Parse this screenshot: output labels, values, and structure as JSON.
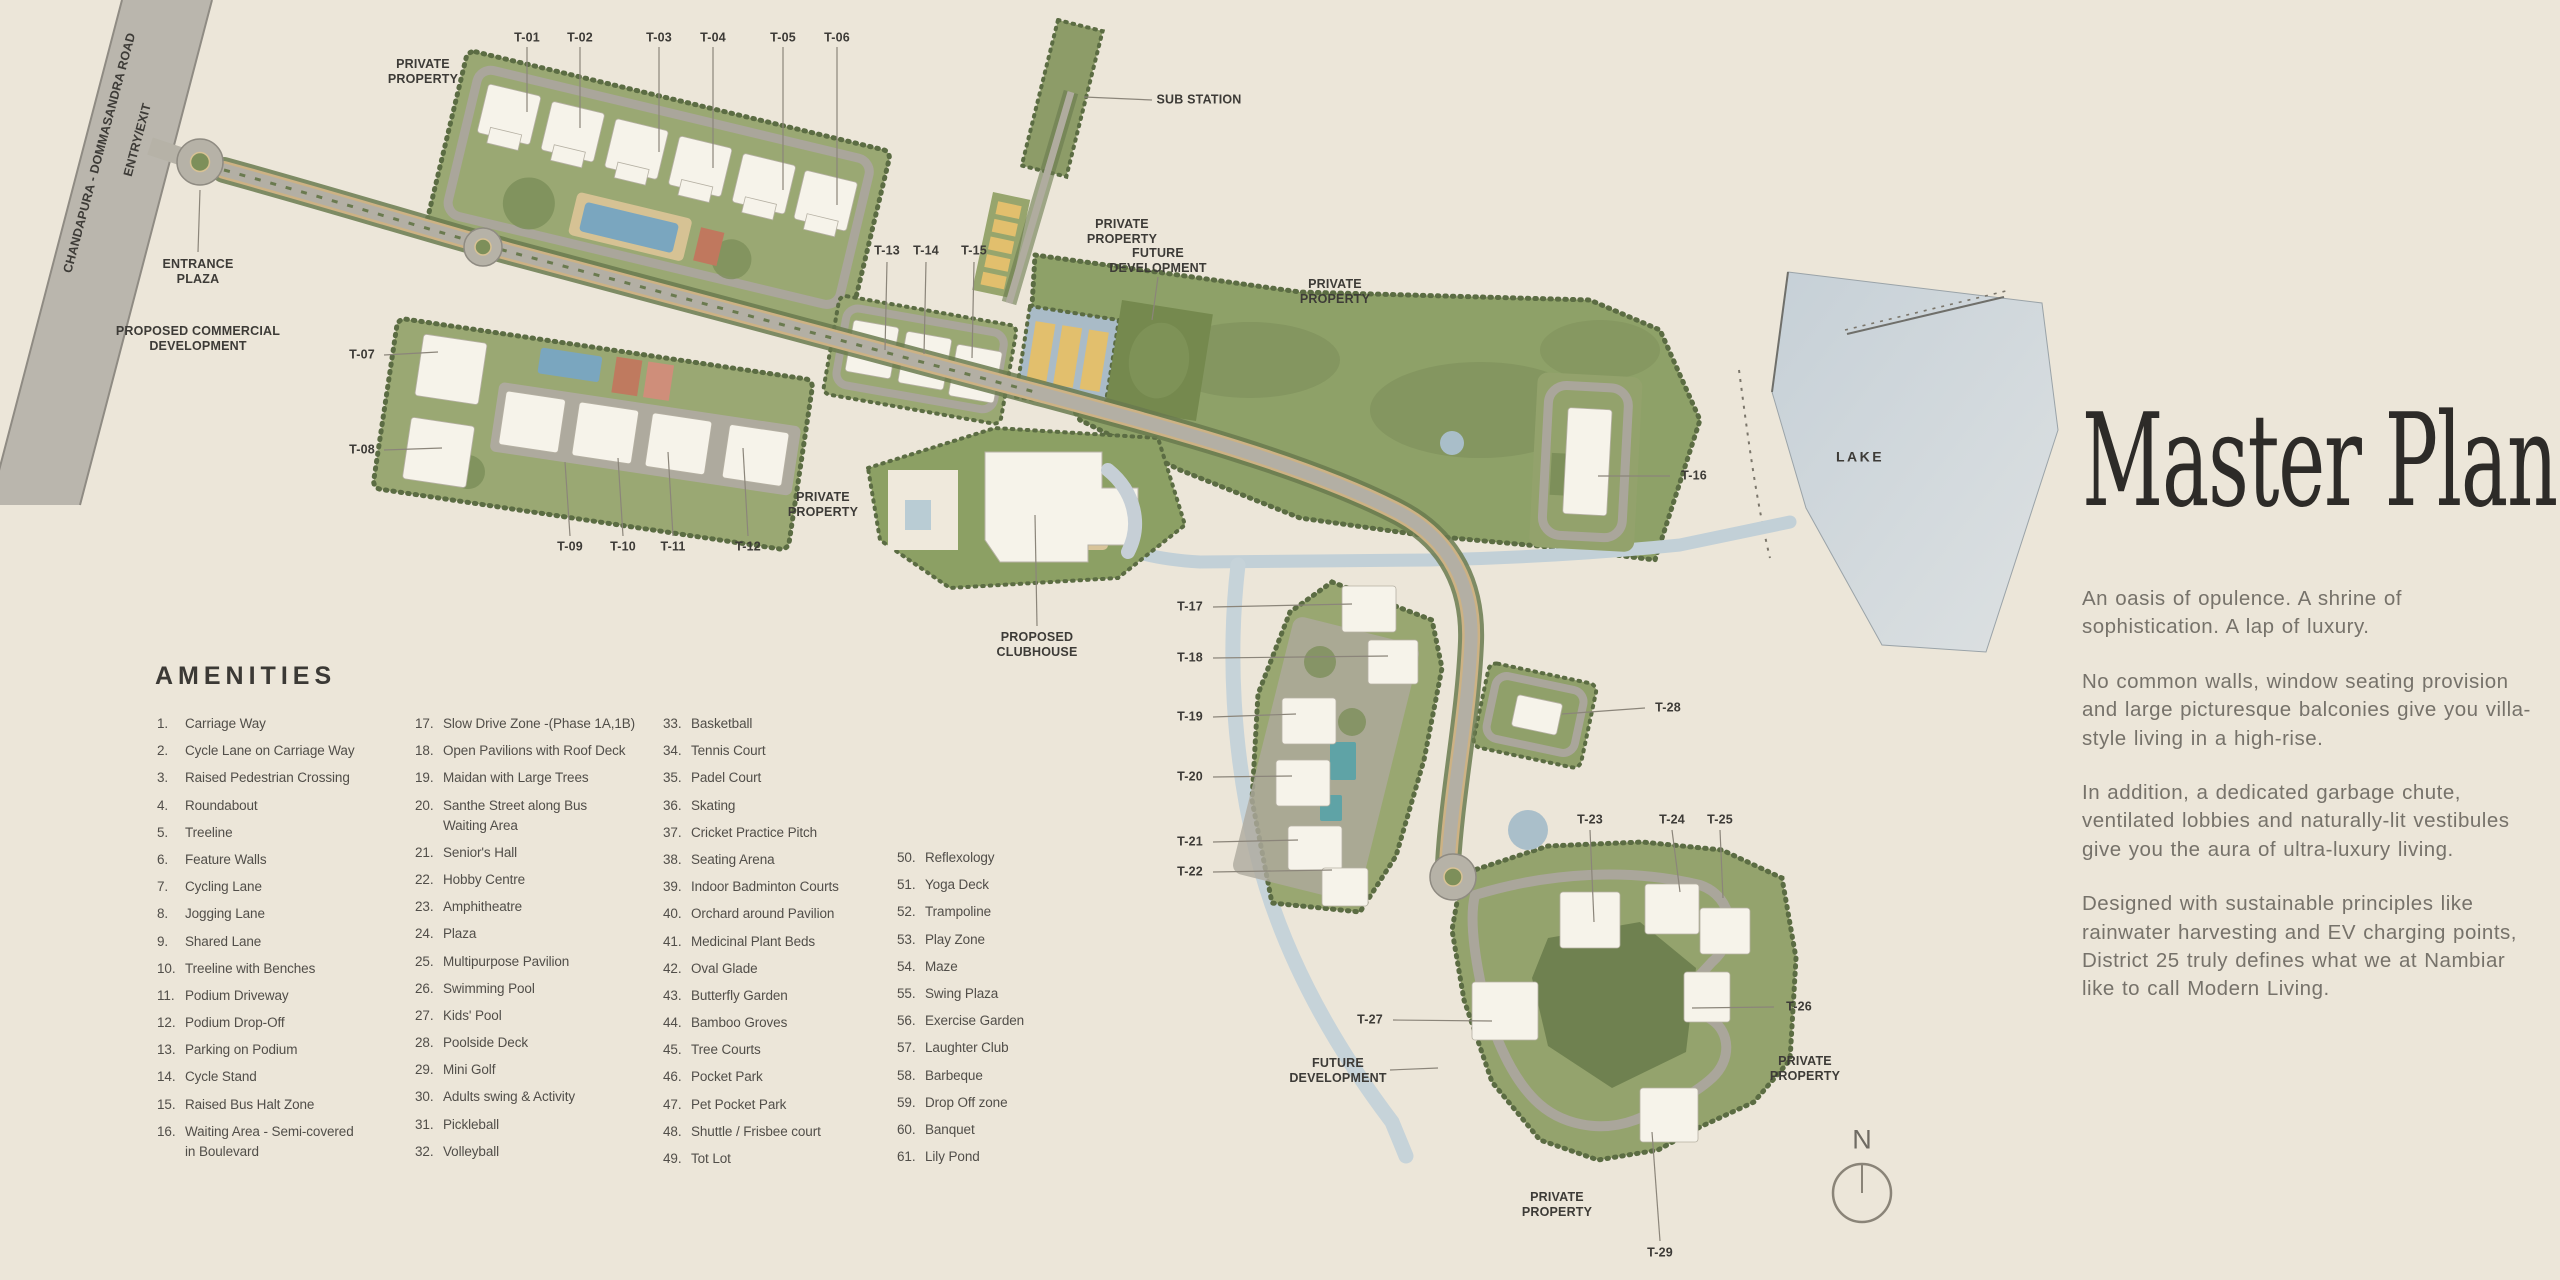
{
  "map": {
    "compass_n": "N",
    "towers": [
      {
        "id": "T-01",
        "x": 527,
        "y": 38,
        "leader": [
          527,
          47,
          527,
          112
        ]
      },
      {
        "id": "T-02",
        "x": 580,
        "y": 38,
        "leader": [
          580,
          47,
          580,
          128
        ]
      },
      {
        "id": "T-03",
        "x": 659,
        "y": 38,
        "leader": [
          659,
          47,
          659,
          152
        ]
      },
      {
        "id": "T-04",
        "x": 713,
        "y": 38,
        "leader": [
          713,
          47,
          713,
          168
        ]
      },
      {
        "id": "T-05",
        "x": 783,
        "y": 38,
        "leader": [
          783,
          47,
          783,
          190
        ]
      },
      {
        "id": "T-06",
        "x": 837,
        "y": 38,
        "leader": [
          837,
          47,
          837,
          205
        ]
      },
      {
        "id": "T-07",
        "x": 362,
        "y": 355,
        "leader": [
          384,
          355,
          438,
          352
        ]
      },
      {
        "id": "T-08",
        "x": 362,
        "y": 450,
        "leader": [
          384,
          450,
          442,
          448
        ]
      },
      {
        "id": "T-09",
        "x": 570,
        "y": 547,
        "leader": [
          570,
          536,
          565,
          462
        ]
      },
      {
        "id": "T-10",
        "x": 623,
        "y": 547,
        "leader": [
          623,
          536,
          618,
          458
        ]
      },
      {
        "id": "T-11",
        "x": 673,
        "y": 547,
        "leader": [
          673,
          536,
          668,
          452
        ]
      },
      {
        "id": "T-12",
        "x": 748,
        "y": 547,
        "leader": [
          748,
          536,
          743,
          448
        ]
      },
      {
        "id": "T-13",
        "x": 887,
        "y": 251,
        "leader": [
          887,
          262,
          885,
          350
        ]
      },
      {
        "id": "T-14",
        "x": 926,
        "y": 251,
        "leader": [
          926,
          262,
          924,
          354
        ]
      },
      {
        "id": "T-15",
        "x": 974,
        "y": 251,
        "leader": [
          974,
          262,
          972,
          358
        ]
      },
      {
        "id": "T-16",
        "x": 1694,
        "y": 476,
        "leader": [
          1670,
          476,
          1598,
          476
        ]
      },
      {
        "id": "T-17",
        "x": 1190,
        "y": 607,
        "leader": [
          1213,
          607,
          1352,
          604
        ]
      },
      {
        "id": "T-18",
        "x": 1190,
        "y": 658,
        "leader": [
          1213,
          658,
          1388,
          656
        ]
      },
      {
        "id": "T-19",
        "x": 1190,
        "y": 717,
        "leader": [
          1213,
          717,
          1296,
          714
        ]
      },
      {
        "id": "T-20",
        "x": 1190,
        "y": 777,
        "leader": [
          1213,
          777,
          1292,
          776
        ]
      },
      {
        "id": "T-21",
        "x": 1190,
        "y": 842,
        "leader": [
          1213,
          842,
          1298,
          840
        ]
      },
      {
        "id": "T-22",
        "x": 1190,
        "y": 872,
        "leader": [
          1213,
          872,
          1332,
          870
        ]
      },
      {
        "id": "T-23",
        "x": 1590,
        "y": 820,
        "leader": [
          1590,
          830,
          1594,
          922
        ]
      },
      {
        "id": "T-24",
        "x": 1672,
        "y": 820,
        "leader": [
          1672,
          830,
          1680,
          892
        ]
      },
      {
        "id": "T-25",
        "x": 1720,
        "y": 820,
        "leader": [
          1720,
          830,
          1723,
          898
        ]
      },
      {
        "id": "T-26",
        "x": 1799,
        "y": 1007,
        "leader": [
          1774,
          1007,
          1692,
          1008
        ]
      },
      {
        "id": "T-27",
        "x": 1370,
        "y": 1020,
        "leader": [
          1393,
          1020,
          1492,
          1021
        ]
      },
      {
        "id": "T-28",
        "x": 1668,
        "y": 708,
        "leader": [
          1645,
          708,
          1562,
          714
        ]
      },
      {
        "id": "T-29",
        "x": 1660,
        "y": 1253,
        "leader": [
          1660,
          1241,
          1652,
          1132
        ]
      }
    ],
    "area_labels": [
      {
        "name": "private-property-1",
        "text": "PRIVATE\nPROPERTY",
        "x": 423,
        "y": 72
      },
      {
        "name": "sub-station",
        "text": "SUB STATION",
        "x": 1199,
        "y": 100,
        "leader": [
          1152,
          100,
          1084,
          97
        ]
      },
      {
        "name": "private-property-2",
        "text": "PRIVATE\nPROPERTY",
        "x": 1122,
        "y": 232
      },
      {
        "name": "future-development-1",
        "text": "FUTURE\nDEVELOPMENT",
        "x": 1158,
        "y": 261,
        "leader": [
          1158,
          277,
          1152,
          320
        ]
      },
      {
        "name": "private-property-3",
        "text": "PRIVATE\nPROPERTY",
        "x": 1335,
        "y": 292
      },
      {
        "name": "entrance-plaza",
        "text": "ENTRANCE\nPLAZA",
        "x": 198,
        "y": 272,
        "leader": [
          198,
          252,
          200,
          190
        ]
      },
      {
        "name": "proposed-commercial-development",
        "text": "PROPOSED COMMERCIAL\nDEVELOPMENT",
        "x": 198,
        "y": 339
      },
      {
        "name": "private-property-4",
        "text": "PRIVATE\nPROPERTY",
        "x": 823,
        "y": 505
      },
      {
        "name": "proposed-clubhouse",
        "text": "PROPOSED\nCLUBHOUSE",
        "x": 1037,
        "y": 645,
        "leader": [
          1037,
          626,
          1035,
          515
        ]
      },
      {
        "name": "lake",
        "text": "LAKE",
        "x": 1860,
        "y": 457,
        "cls": "lake"
      },
      {
        "name": "private-property-5",
        "text": "PRIVATE\nPROPERTY",
        "x": 1805,
        "y": 1069
      },
      {
        "name": "future-development-2",
        "text": "FUTURE\nDEVELOPMENT",
        "x": 1338,
        "y": 1071,
        "leader": [
          1390,
          1070,
          1438,
          1068
        ]
      },
      {
        "name": "private-property-6",
        "text": "PRIVATE\nPROPERTY",
        "x": 1557,
        "y": 1205
      },
      {
        "name": "entry-exit",
        "text": "ENTRY/EXIT",
        "x": 138,
        "y": 140,
        "rotate": -75
      },
      {
        "name": "chandapura-dommasandra-road",
        "text": "CHANDAPURA - DOMMASANDRA ROAD",
        "x": 100,
        "y": 153,
        "rotate": -75
      }
    ]
  },
  "amenities": {
    "title": "AMENITIES",
    "columns": [
      {
        "x": 157,
        "top": 714,
        "items": [
          {
            "n": "1.",
            "label": "Carriage Way"
          },
          {
            "n": "2.",
            "label": "Cycle Lane on Carriage Way"
          },
          {
            "n": "3.",
            "label": "Raised Pedestrian Crossing"
          },
          {
            "n": "4.",
            "label": "Roundabout"
          },
          {
            "n": "5.",
            "label": "Treeline"
          },
          {
            "n": "6.",
            "label": "Feature Walls"
          },
          {
            "n": "7.",
            "label": "Cycling Lane"
          },
          {
            "n": "8.",
            "label": "Jogging Lane"
          },
          {
            "n": "9.",
            "label": "Shared Lane"
          },
          {
            "n": "10.",
            "label": "Treeline with Benches"
          },
          {
            "n": "11.",
            "label": "Podium Driveway"
          },
          {
            "n": "12.",
            "label": "Podium Drop-Off"
          },
          {
            "n": "13.",
            "label": "Parking on Podium"
          },
          {
            "n": "14.",
            "label": "Cycle Stand"
          },
          {
            "n": "15.",
            "label": "Raised Bus Halt Zone"
          },
          {
            "n": "16.",
            "label": "Waiting Area - Semi-covered\nin Boulevard"
          }
        ]
      },
      {
        "x": 415,
        "top": 714,
        "items": [
          {
            "n": "17.",
            "label": "Slow Drive Zone -(Phase 1A,1B)"
          },
          {
            "n": "18.",
            "label": "Open Pavilions with Roof Deck"
          },
          {
            "n": "19.",
            "label": "Maidan with Large Trees"
          },
          {
            "n": "20.",
            "label": "Santhe Street along Bus\nWaiting Area"
          },
          {
            "n": "21.",
            "label": "Senior's Hall"
          },
          {
            "n": "22.",
            "label": "Hobby Centre"
          },
          {
            "n": "23.",
            "label": "Amphitheatre"
          },
          {
            "n": "24.",
            "label": "Plaza"
          },
          {
            "n": "25.",
            "label": "Multipurpose Pavilion"
          },
          {
            "n": "26.",
            "label": "Swimming Pool"
          },
          {
            "n": "27.",
            "label": "Kids' Pool"
          },
          {
            "n": "28.",
            "label": "Poolside Deck"
          },
          {
            "n": "29.",
            "label": "Mini Golf"
          },
          {
            "n": "30.",
            "label": "Adults swing & Activity"
          },
          {
            "n": "31.",
            "label": "Pickleball"
          },
          {
            "n": "32.",
            "label": "Volleyball"
          }
        ]
      },
      {
        "x": 663,
        "top": 714,
        "items": [
          {
            "n": "33.",
            "label": "Basketball"
          },
          {
            "n": "34.",
            "label": "Tennis Court"
          },
          {
            "n": "35.",
            "label": "Padel Court"
          },
          {
            "n": "36.",
            "label": "Skating"
          },
          {
            "n": "37.",
            "label": "Cricket Practice Pitch"
          },
          {
            "n": "38.",
            "label": "Seating Arena"
          },
          {
            "n": "39.",
            "label": "Indoor Badminton Courts"
          },
          {
            "n": "40.",
            "label": "Orchard around Pavilion"
          },
          {
            "n": "41.",
            "label": "Medicinal Plant Beds"
          },
          {
            "n": "42.",
            "label": "Oval Glade"
          },
          {
            "n": "43.",
            "label": "Butterfly Garden"
          },
          {
            "n": "44.",
            "label": "Bamboo Groves"
          },
          {
            "n": "45.",
            "label": "Tree Courts"
          },
          {
            "n": "46.",
            "label": "Pocket Park"
          },
          {
            "n": "47.",
            "label": "Pet Pocket Park"
          },
          {
            "n": "48.",
            "label": "Shuttle / Frisbee court"
          },
          {
            "n": "49.",
            "label": "Tot Lot"
          }
        ]
      },
      {
        "x": 897,
        "top": 848,
        "items": [
          {
            "n": "50.",
            "label": "Reflexology"
          },
          {
            "n": "51.",
            "label": "Yoga Deck"
          },
          {
            "n": "52.",
            "label": "Trampoline"
          },
          {
            "n": "53.",
            "label": "Play Zone"
          },
          {
            "n": "54.",
            "label": "Maze"
          },
          {
            "n": "55.",
            "label": "Swing Plaza"
          },
          {
            "n": "56.",
            "label": "Exercise Garden"
          },
          {
            "n": "57.",
            "label": "Laughter Club"
          },
          {
            "n": "58.",
            "label": "Barbeque"
          },
          {
            "n": "59.",
            "label": "Drop Off zone"
          },
          {
            "n": "60.",
            "label": "Banquet"
          },
          {
            "n": "61.",
            "label": "Lily Pond"
          }
        ]
      }
    ]
  },
  "panel": {
    "title": "Master Plan",
    "paragraphs": [
      "An oasis of opulence. A shrine of sophistication. A lap of luxury.",
      "No common walls, window seating provision and large picturesque balconies give you villa-style living in a high-rise.",
      "In addition, a dedicated garbage chute, ventilated lobbies and naturally-lit vestibules give you the aura of ultra-luxury living.",
      "Designed with sustainable principles like rainwater harvesting and EV charging points, District 25 truly defines what we at Nambiar like to call Modern Living."
    ]
  }
}
